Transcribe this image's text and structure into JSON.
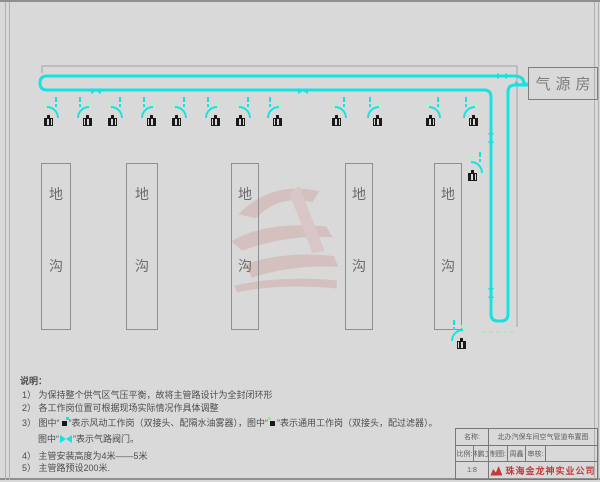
{
  "colors": {
    "pipe": "#17e2e2",
    "outline": "#a3a3a3",
    "red": "#c23b3b",
    "green": "#9fe8a8"
  },
  "air_source_room": {
    "label": "气源房"
  },
  "trench": {
    "char_top": "地",
    "char_bottom": "沟",
    "y": 163,
    "h": 167,
    "boxes": [
      {
        "x": 41,
        "w": 30
      },
      {
        "x": 126,
        "w": 32
      },
      {
        "x": 231,
        "w": 28
      },
      {
        "x": 345,
        "w": 28
      },
      {
        "x": 434,
        "w": 28
      }
    ]
  },
  "workstations": [
    {
      "x": 44,
      "y": 97,
      "flip": false
    },
    {
      "x": 74,
      "y": 97,
      "flip": true
    },
    {
      "x": 108,
      "y": 97,
      "flip": false
    },
    {
      "x": 138,
      "y": 97,
      "flip": true
    },
    {
      "x": 172,
      "y": 97,
      "flip": false
    },
    {
      "x": 202,
      "y": 97,
      "flip": true
    },
    {
      "x": 236,
      "y": 97,
      "flip": false
    },
    {
      "x": 264,
      "y": 97,
      "flip": true
    },
    {
      "x": 332,
      "y": 97,
      "flip": false
    },
    {
      "x": 364,
      "y": 97,
      "flip": true
    },
    {
      "x": 426,
      "y": 97,
      "flip": false
    },
    {
      "x": 460,
      "y": 97,
      "flip": true
    },
    {
      "x": 468,
      "y": 152,
      "flip": false
    },
    {
      "x": 448,
      "y": 320,
      "flip": true
    }
  ],
  "valves": [
    {
      "x": 96,
      "y": 91,
      "o": "h"
    },
    {
      "x": 303,
      "y": 91,
      "o": "h"
    },
    {
      "x": 502,
      "y": 76,
      "o": "h"
    },
    {
      "x": 520,
      "y": 84,
      "o": "h"
    },
    {
      "x": 491,
      "y": 138,
      "o": "v"
    },
    {
      "x": 491,
      "y": 293,
      "o": "v"
    }
  ],
  "notes": {
    "heading": "说明：",
    "line1": "1） 为保持整个供气区气压平衡，故将主管路设计为全封闭环形",
    "line2": "2） 各工作岗位置可根据现场实际情况作具体调整",
    "line3a": "3） 图中“",
    "line3b": "”表示风动工作岗（双接头、配隔水油雾器），图中“",
    "line3c": "”表示通用工作岗（双接头，配过滤器）。",
    "line4a": "图中“",
    "line4b": "”表示气路阀门。",
    "line5": "4） 主管安装高度为4米——5米",
    "line6": "5） 主管路预设200米."
  },
  "title_block": {
    "name_label": "名称:",
    "drawing_title": "北办汽保车间空气管道布置图",
    "row2": [
      "比例:",
      "林鹏工",
      "制图:",
      "周鑫",
      "审核:",
      ""
    ],
    "scale_value": "1:8",
    "company": "珠海金龙神实业公司"
  }
}
